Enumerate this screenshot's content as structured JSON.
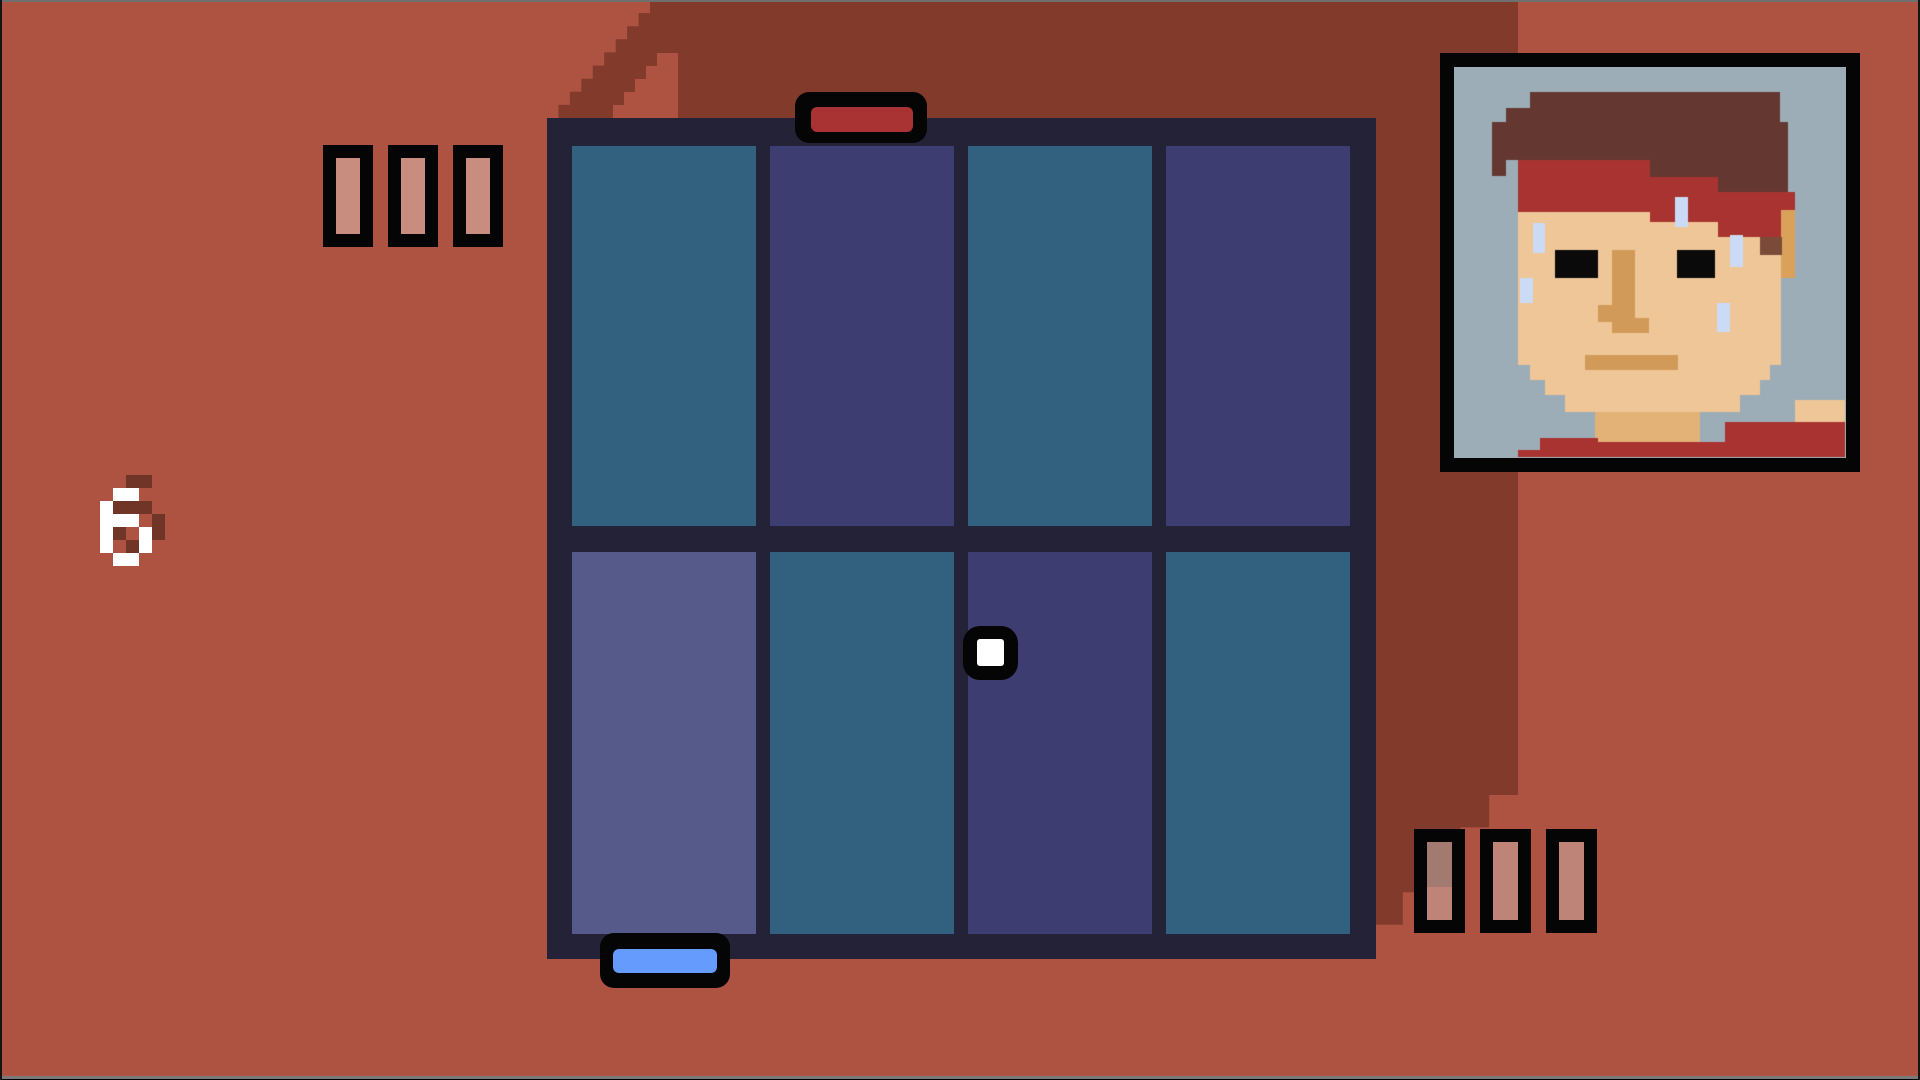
{
  "palette": {
    "background": "#ae5242",
    "background_shadow": "#823a2b",
    "court_frame": "#242236",
    "cell_teal": "#31617f",
    "cell_purple": "#3e3d71",
    "cell_slate": "#565a8a",
    "paddle_red": "#a93333",
    "paddle_blue": "#669bfe",
    "ball_white": "#ffffff",
    "outline_black": "#050505",
    "tally_pink_bright": "#c98d80",
    "tally_pink": "#bf8478",
    "tally_pink_shadow": "#a27a6f",
    "digit_white": "#ffffff",
    "digit_shadow": "#703526",
    "edge_top": "#6f6f6f",
    "edge_bottom": "#7a7a7a"
  },
  "hud": {
    "round_number": "6",
    "top_left_tallies": {
      "count": 3,
      "fills": [
        "tally_pink_bright",
        "tally_pink_bright",
        "tally_pink_bright"
      ]
    },
    "bottom_right_tallies": {
      "count": 3,
      "fills": [
        "shaded",
        "tally_pink",
        "tally_pink"
      ]
    }
  },
  "court": {
    "rows": 2,
    "cols": 4,
    "cell_colors": [
      [
        "cell_teal",
        "cell_purple",
        "cell_teal",
        "cell_purple"
      ],
      [
        "cell_slate",
        "cell_teal",
        "cell_purple",
        "cell_teal"
      ]
    ]
  },
  "paddles": {
    "top": {
      "color": "paddle_red"
    },
    "bottom": {
      "color": "paddle_blue"
    }
  },
  "ball": {
    "color": "ball_white"
  },
  "digit_glyphs": {
    "6": [
      ".WW.",
      "W...",
      "WWW.",
      "W..W",
      "W..W",
      ".WW."
    ]
  },
  "portrait": {
    "palette": {
      "bg": "#9cadb7",
      "hair": "#643831",
      "hair_light": "#7c4a38",
      "band": "#a93330",
      "skin": "#eec698",
      "shade": "#d29a59",
      "ear": "#d9a159",
      "neck": "#e2b277",
      "sweat": "#ccdbf5",
      "black": "#0a0a0a"
    },
    "layers": [
      {
        "color": "bg",
        "rects": [
          [
            0,
            0,
            375,
            387
          ]
        ]
      },
      {
        "color": "hair",
        "rects": [
          [
            60,
            22,
            250,
            16
          ],
          [
            36,
            38,
            274,
            14
          ],
          [
            22,
            52,
            296,
            21
          ],
          [
            22,
            73,
            296,
            17
          ],
          [
            22,
            90,
            14,
            16
          ],
          [
            180,
            90,
            138,
            17
          ],
          [
            248,
            107,
            70,
            15
          ],
          [
            285,
            155,
            20,
            17
          ]
        ]
      },
      {
        "color": "band",
        "rects": [
          [
            48,
            90,
            132,
            52
          ],
          [
            180,
            107,
            68,
            45
          ],
          [
            248,
            122,
            77,
            45
          ]
        ]
      },
      {
        "color": "skin",
        "rects": [
          [
            48,
            142,
            132,
            153
          ],
          [
            180,
            152,
            68,
            143
          ],
          [
            248,
            167,
            63,
            128
          ],
          [
            60,
            295,
            240,
            15
          ],
          [
            75,
            310,
            215,
            15
          ],
          [
            95,
            325,
            175,
            17
          ],
          [
            325,
            330,
            50,
            22
          ]
        ]
      },
      {
        "color": "ear",
        "rects": [
          [
            311,
            140,
            14,
            68
          ]
        ]
      },
      {
        "color": "hair_light",
        "rects": [
          [
            290,
            167,
            22,
            18
          ]
        ]
      },
      {
        "color": "black",
        "rects": [
          [
            85,
            180,
            43,
            28
          ],
          [
            207,
            180,
            38,
            28
          ]
        ]
      },
      {
        "color": "shade",
        "rects": [
          [
            142,
            180,
            23,
            72
          ],
          [
            128,
            235,
            14,
            17
          ],
          [
            142,
            248,
            37,
            15
          ],
          [
            115,
            285,
            93,
            15
          ]
        ]
      },
      {
        "color": "neck",
        "rects": [
          [
            125,
            342,
            105,
            36
          ]
        ]
      },
      {
        "color": "band",
        "rects": [
          [
            255,
            352,
            120,
            35
          ],
          [
            128,
            372,
            130,
            15
          ],
          [
            70,
            368,
            58,
            19
          ],
          [
            48,
            380,
            327,
            7
          ]
        ]
      },
      {
        "color": "sweat",
        "rects": [
          [
            205,
            127,
            13,
            30
          ],
          [
            63,
            153,
            12,
            30
          ],
          [
            50,
            208,
            13,
            25
          ],
          [
            260,
            165,
            13,
            32
          ],
          [
            247,
            233,
            13,
            29
          ]
        ]
      }
    ]
  }
}
